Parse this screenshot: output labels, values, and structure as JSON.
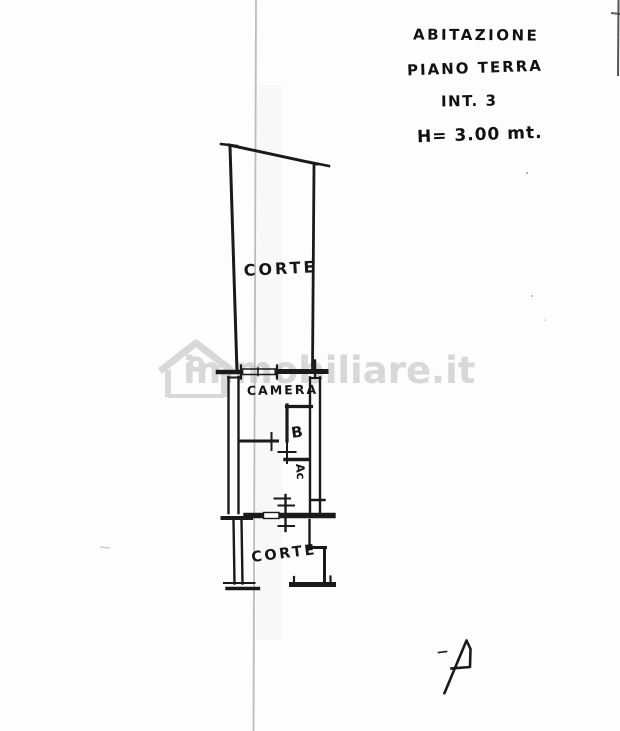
{
  "annotations": {
    "property_type": "ABITAZIONE",
    "floor": "PIANO TERRA",
    "unit": "INT. 3",
    "ceiling_height": "H= 3.00 mt."
  },
  "plan": {
    "upper_courtyard_label": "CORTE",
    "bedroom_label": "CAMERA",
    "bathroom_label": "B",
    "ac_label": "Ac",
    "lower_courtyard_label": "CORTE"
  },
  "watermark": {
    "text": "immobiliare.it"
  },
  "colors": {
    "paper": "#fdfdfc",
    "ink": "#1a1a1a",
    "fold_line": "#bcbcbc",
    "watermark": "#d8d8d8"
  }
}
